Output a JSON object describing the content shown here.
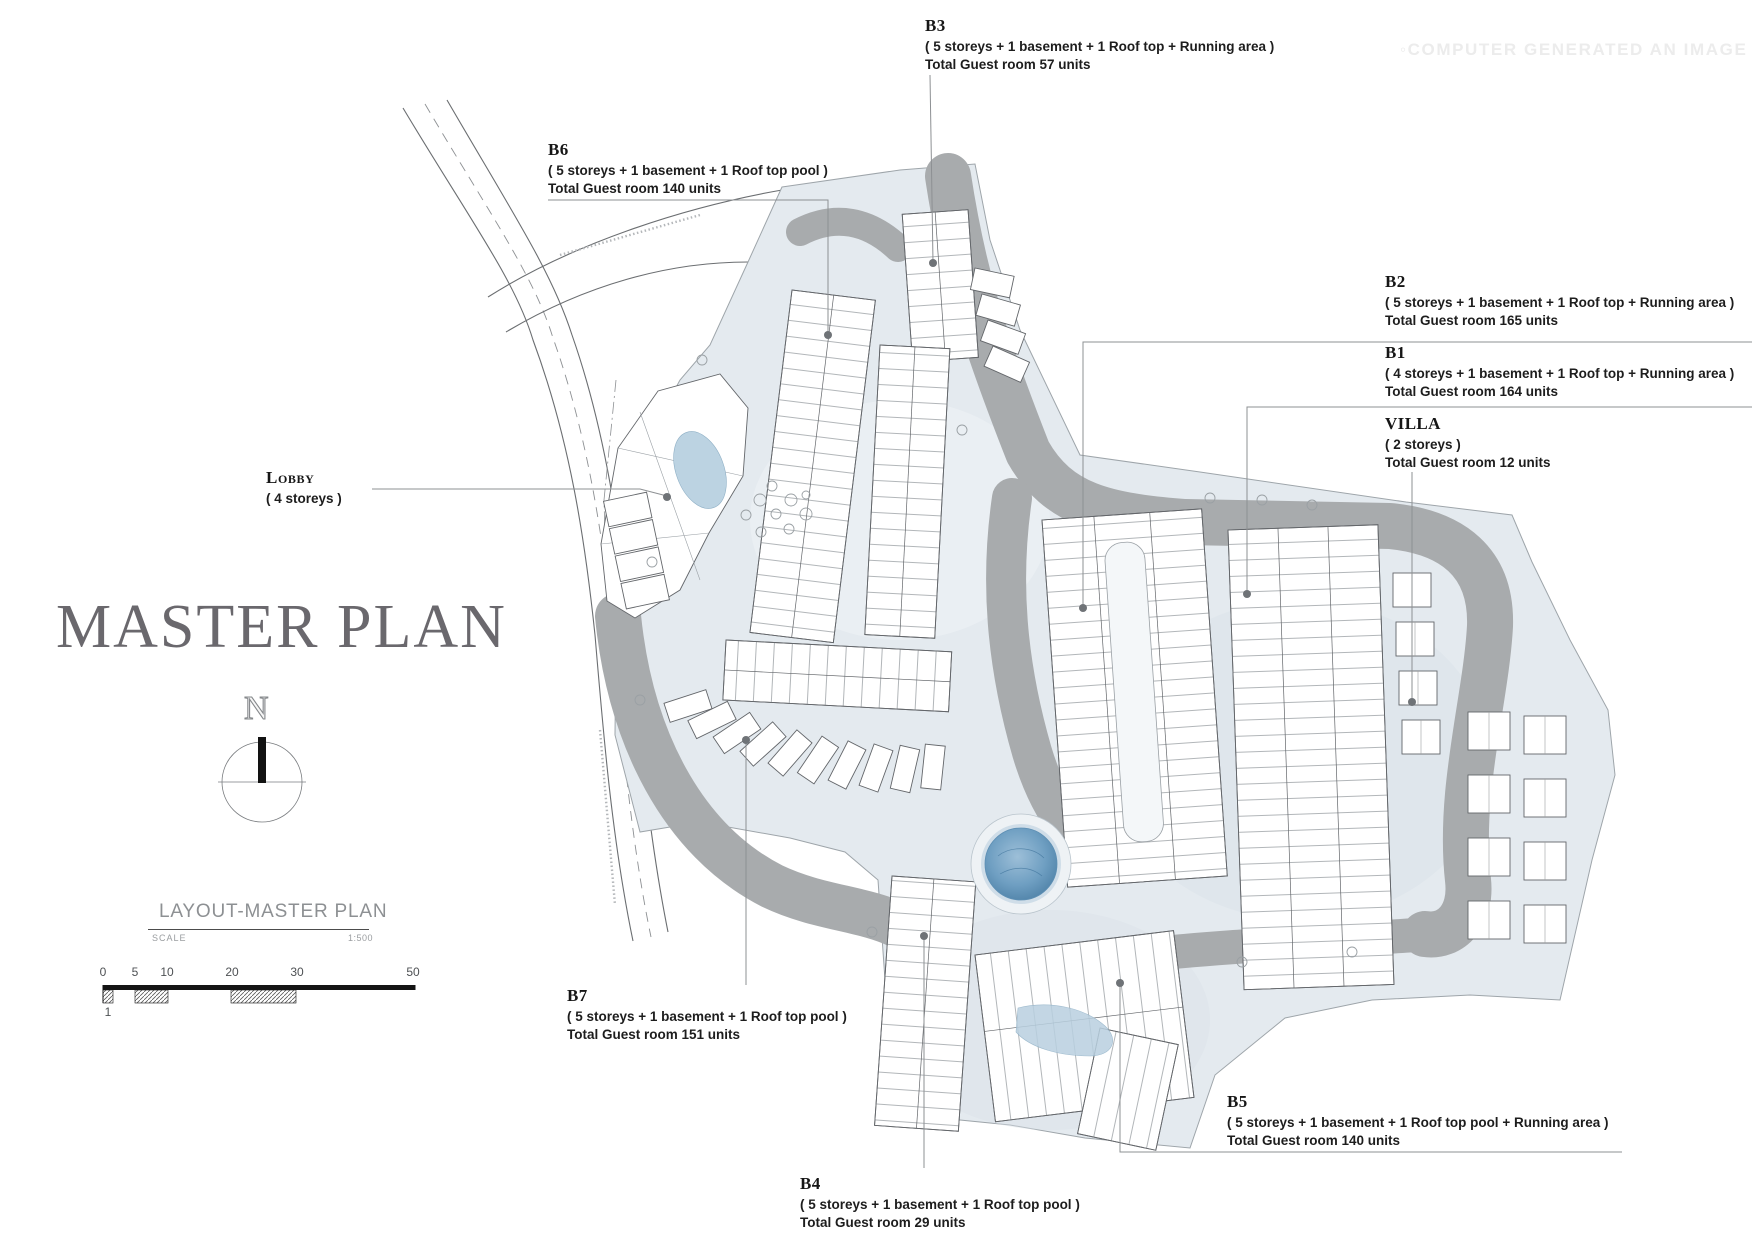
{
  "meta": {
    "watermark": "◦COMPUTER GENERATED AN IMAGE"
  },
  "title": {
    "text": "MASTER PLAN"
  },
  "compass": {
    "north_label": "N"
  },
  "legend": {
    "heading": "LAYOUT-MASTER PLAN",
    "scale_label": "SCALE",
    "scale_value": "1:500",
    "scale_ticks": [
      "0",
      "5",
      "10",
      "20",
      "30",
      "50"
    ],
    "scale_sub_tick": "1"
  },
  "labels": {
    "b3": {
      "title": "B3",
      "desc": "( 5 storeys + 1 basement + 1 Roof top + Running area )",
      "total": "Total Guest room 57 units"
    },
    "b6": {
      "title": "B6",
      "desc": "( 5 storeys + 1 basement + 1 Roof top pool )",
      "total": "Total Guest room 140 units"
    },
    "b2": {
      "title": "B2",
      "desc": "( 5 storeys + 1 basement + 1 Roof top + Running area )",
      "total": "Total Guest room 165 units"
    },
    "b1": {
      "title": "B1",
      "desc": "( 4 storeys + 1 basement + 1 Roof top + Running area )",
      "total": "Total Guest room 164 units"
    },
    "villa": {
      "title": "VILLA",
      "desc": "( 2 storeys )",
      "total": "Total Guest room 12 units"
    },
    "lobby": {
      "title": "Lobby",
      "desc": "( 4 storeys )"
    },
    "b7": {
      "title": "B7",
      "desc": "( 5 storeys + 1 basement + 1 Roof top pool )",
      "total": "Total Guest room 151 units"
    },
    "b5": {
      "title": "B5",
      "desc": "( 5 storeys + 1 basement + 1 Roof top pool + Running area )",
      "total": "Total Guest room 140 units"
    },
    "b4": {
      "title": "B4",
      "desc": "( 5 storeys + 1 basement + 1 Roof top pool )",
      "total": "Total Guest room 29 units"
    }
  },
  "colors": {
    "site_ground": "#e4eaef",
    "internal_road": "#a8abad",
    "pool_water": "#5d8fb4",
    "building_fill": "#ffffff",
    "building_line": "#63666a",
    "leader_line": "#8d9093",
    "master_title": "#6a686d",
    "watermark": "#ececec"
  }
}
